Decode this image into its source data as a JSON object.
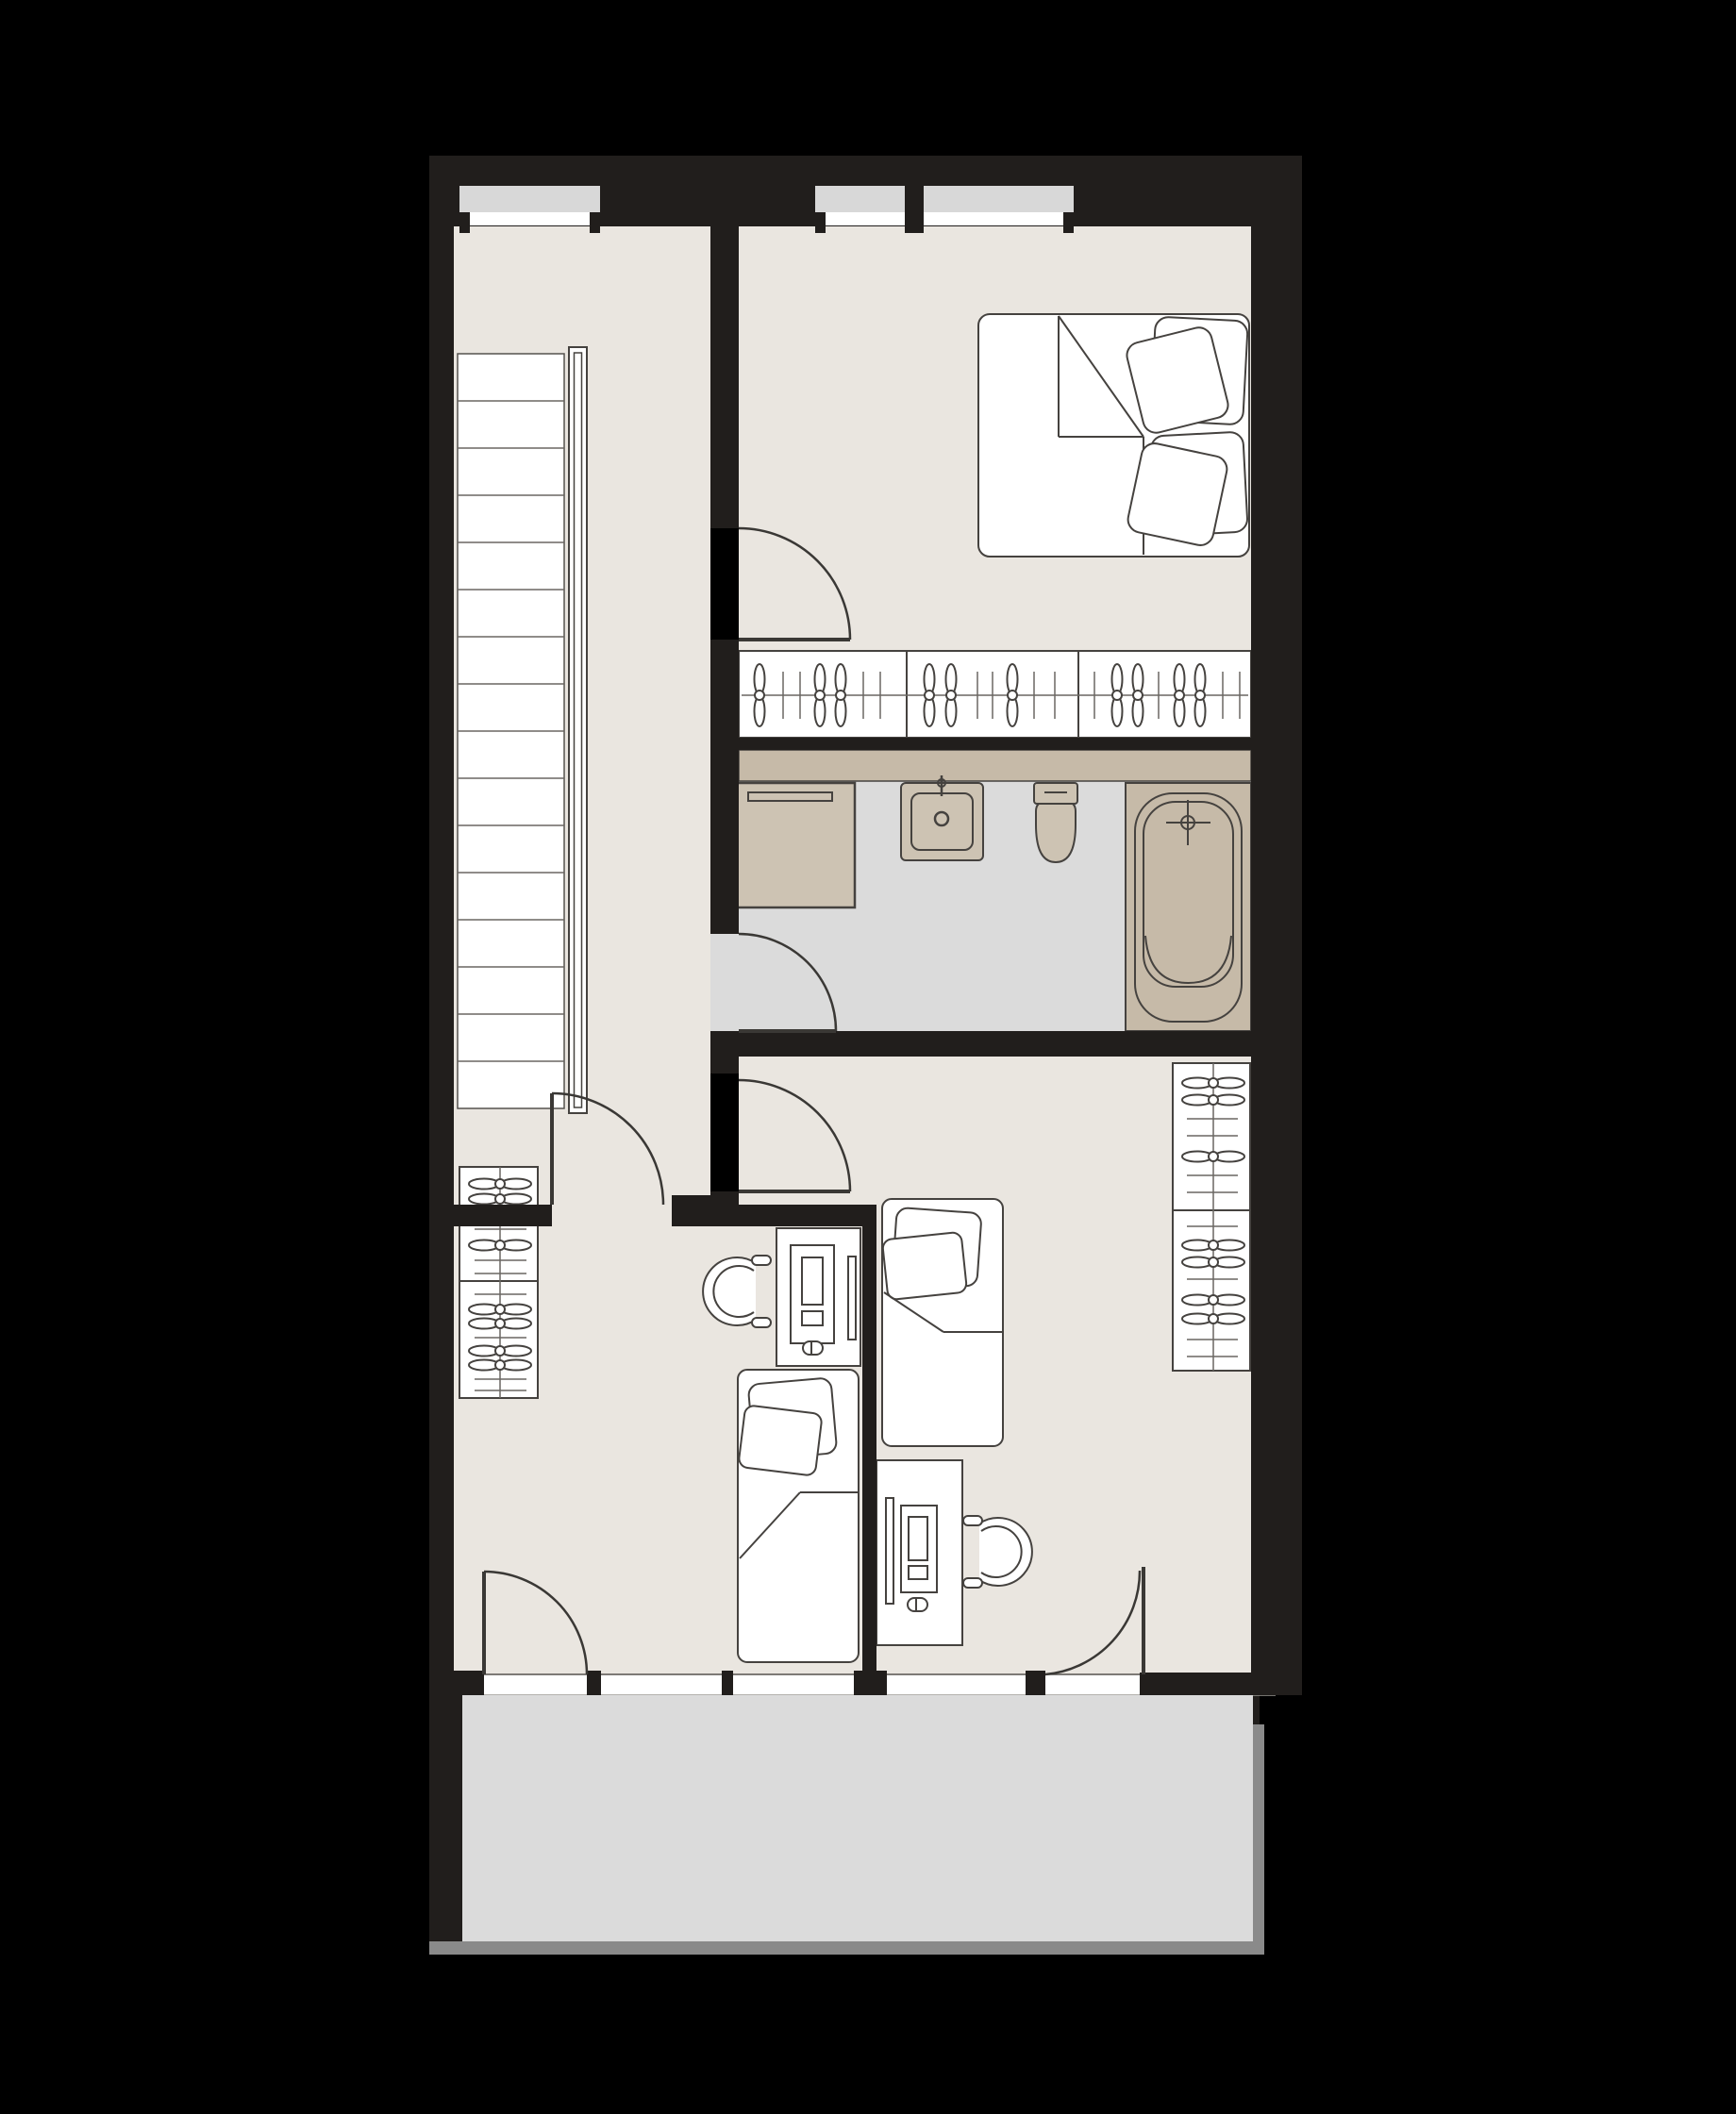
{
  "app": {
    "type": "architectural-floor-plan",
    "view": "upper-floor-with-balcony",
    "visible_text": ""
  },
  "palette": {
    "bg": "#000000",
    "wall": "#211E1C",
    "floor": "#EAE6E0",
    "bathFloor": "#DBDBDB",
    "balcony": "#DBDBDB",
    "railing": "#8A8A8A",
    "sill": "#D8D8D8",
    "glazing": "#FFFFFF",
    "counterTan": "#C6BAA8",
    "fixtureTan": "#CDC3B3",
    "line": "#45423F",
    "furnitureFill": "#FFFFFF"
  },
  "rooms": [
    {
      "id": "stair-hall"
    },
    {
      "id": "bedroom"
    },
    {
      "id": "wardrobe-closet"
    },
    {
      "id": "bathroom"
    },
    {
      "id": "kids-room-left"
    },
    {
      "id": "kids-room-right"
    },
    {
      "id": "balcony"
    }
  ],
  "furniture": [
    "staircase",
    "handrail",
    "double-bed",
    "pillows",
    "closet-hanger-rail",
    "washing-machine",
    "wash-basin",
    "toilet",
    "bathtub",
    "wardrobe-left",
    "wardrobe-right",
    "single-bed",
    "desk",
    "computer-tower",
    "monitor",
    "mouse",
    "desk-chair"
  ],
  "doors": [
    "bedroom-door",
    "bathroom-door",
    "kids-room-left-door",
    "kids-room-right-door",
    "balcony-door-left",
    "balcony-door-right"
  ],
  "windows": [
    "top-window-1",
    "top-window-2a",
    "top-window-2b",
    "bottom-window-1",
    "bottom-window-2",
    "bottom-window-3"
  ]
}
